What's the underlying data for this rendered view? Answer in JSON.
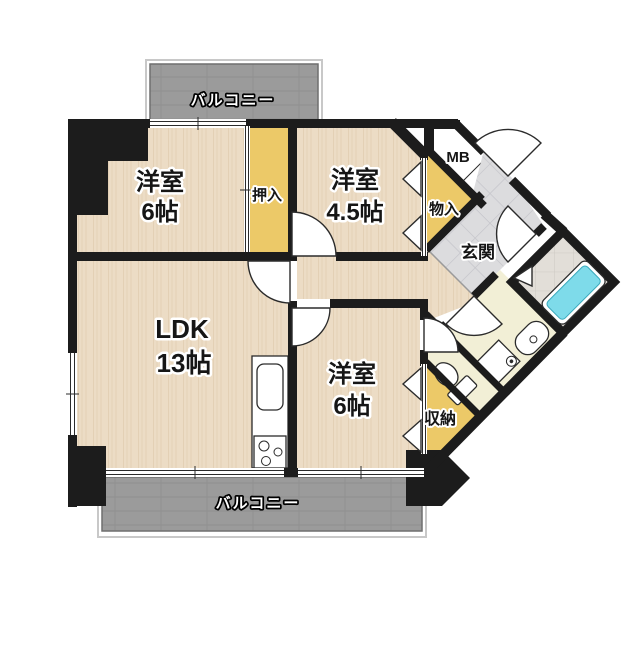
{
  "page": {
    "background": "#ffffff"
  },
  "colors": {
    "wall": "#1c1c1c",
    "wood_base": "#ecdcc5",
    "wood_grain": "#dcc6a8",
    "closet_yellow": "#ecc968",
    "balcony_gray": "#9b9b9b",
    "genkan_tile": "#dcdcde",
    "bath_tile": "#e2ded8",
    "bathtub_cyan": "#7edbea",
    "sanitary_cream": "#f2efd6",
    "fixture_white": "#ffffff"
  },
  "labels": {
    "balcony_top": "バルコニー",
    "balcony_bottom": "バルコニー",
    "room_west_name": "洋室",
    "room_west_size": "6帖",
    "oshiire": "押入",
    "room_ne_name": "洋室",
    "room_ne_size": "4.5帖",
    "meter_box": "MB",
    "monoire": "物入",
    "genkan": "玄関",
    "ldk_name": "LDK",
    "ldk_size": "13帖",
    "room_south_name": "洋室",
    "room_south_size": "6帖",
    "shunou": "収納"
  }
}
